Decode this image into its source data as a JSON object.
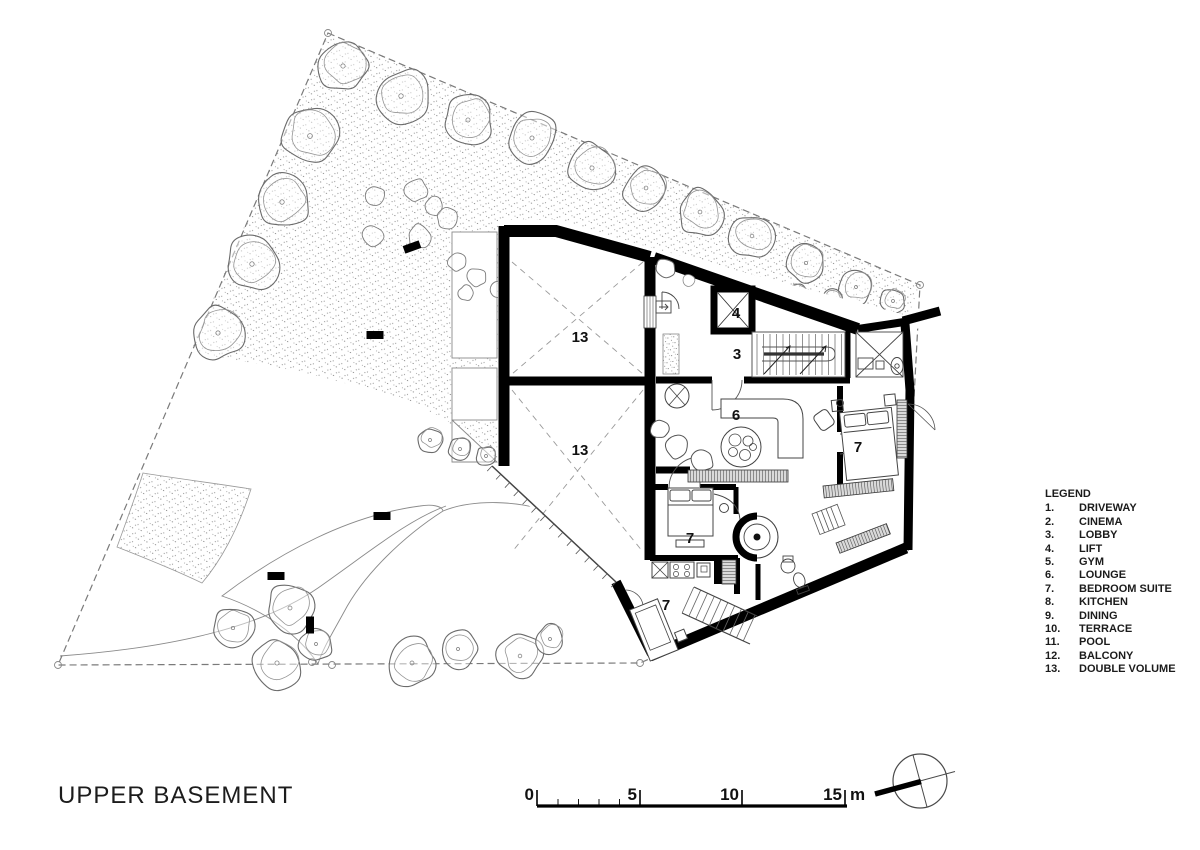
{
  "title": "UPPER BASEMENT",
  "legend": {
    "heading": "LEGEND",
    "items": [
      {
        "num": "1.",
        "label": "DRIVEWAY"
      },
      {
        "num": "2.",
        "label": "CINEMA"
      },
      {
        "num": "3.",
        "label": "LOBBY"
      },
      {
        "num": "4.",
        "label": "LIFT"
      },
      {
        "num": "5.",
        "label": "GYM"
      },
      {
        "num": "6.",
        "label": "LOUNGE"
      },
      {
        "num": "7.",
        "label": "BEDROOM SUITE"
      },
      {
        "num": "8.",
        "label": "KITCHEN"
      },
      {
        "num": "9.",
        "label": "DINING"
      },
      {
        "num": "10.",
        "label": "TERRACE"
      },
      {
        "num": "11.",
        "label": "POOL"
      },
      {
        "num": "12.",
        "label": "BALCONY"
      },
      {
        "num": "13.",
        "label": "DOUBLE VOLUME"
      }
    ]
  },
  "plan": {
    "room_labels": [
      {
        "n": "13"
      },
      {
        "n": "13"
      },
      {
        "n": "4"
      },
      {
        "n": "3"
      },
      {
        "n": "6"
      },
      {
        "n": "7"
      },
      {
        "n": "7"
      },
      {
        "n": "7"
      }
    ]
  },
  "scale_bar": {
    "zero": "0",
    "five": "5",
    "ten": "10",
    "fifteen": "15",
    "unit": "m"
  },
  "colors": {
    "ink": "#000000",
    "drawing_line": "#666666",
    "boundary": "#7a7a7a"
  }
}
